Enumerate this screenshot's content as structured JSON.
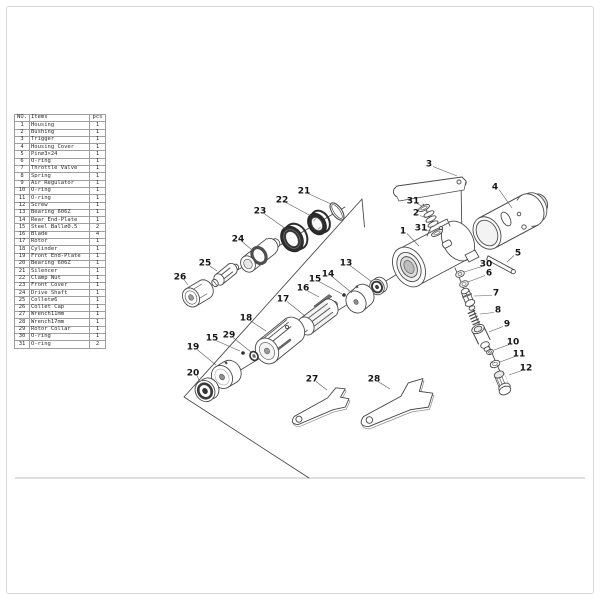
{
  "page": {
    "background": "#ffffff",
    "border_color": "#d8d8d8",
    "ink_color": "#4a4a4a",
    "sheet_line_color": "#bfbfbf"
  },
  "table": {
    "headers": [
      "NO.",
      "Items",
      "pcs"
    ],
    "rows": [
      [
        "1",
        "Housing",
        "1"
      ],
      [
        "2",
        "Bushing",
        "1"
      ],
      [
        "3",
        "Trigger",
        "1"
      ],
      [
        "4",
        "Housing Cover",
        "1"
      ],
      [
        "5",
        "Pin∅3×24",
        "1"
      ],
      [
        "6",
        "O-ring",
        "1"
      ],
      [
        "7",
        "Throttle Valve",
        "1"
      ],
      [
        "8",
        "Spring",
        "1"
      ],
      [
        "9",
        "Air Regulator",
        "1"
      ],
      [
        "10",
        "O-ring",
        "1"
      ],
      [
        "11",
        "O-ring",
        "1"
      ],
      [
        "12",
        "Screw",
        "1"
      ],
      [
        "13",
        "Bearing 606Z",
        "1"
      ],
      [
        "14",
        "Rear End-Plate",
        "1"
      ],
      [
        "15",
        "Steel Ball∅0.5",
        "2"
      ],
      [
        "16",
        "Blade",
        "4"
      ],
      [
        "17",
        "Rotor",
        "1"
      ],
      [
        "18",
        "Cylinder",
        "1"
      ],
      [
        "19",
        "Front End-Plate",
        "1"
      ],
      [
        "20",
        "Bearing 606Z",
        "1"
      ],
      [
        "21",
        "Silencer",
        "1"
      ],
      [
        "22",
        "Clamp Nut",
        "1"
      ],
      [
        "23",
        "Front Cover",
        "1"
      ],
      [
        "24",
        "Drive Shaft",
        "1"
      ],
      [
        "25",
        "Collet∅6",
        "1"
      ],
      [
        "26",
        "Collet Cap",
        "1"
      ],
      [
        "27",
        "Wrench11mm",
        "1"
      ],
      [
        "28",
        "Wrench17mm",
        "1"
      ],
      [
        "29",
        "Rotor Collar",
        "1"
      ],
      [
        "30",
        "O-ring",
        "1"
      ],
      [
        "31",
        "O-ring",
        "2"
      ]
    ]
  },
  "diagram": {
    "callouts": [
      {
        "n": "1",
        "part": "housing",
        "x": 403,
        "y": 231,
        "lx": 419,
        "ly": 246
      },
      {
        "n": "2",
        "part": "bushing",
        "x": 416,
        "y": 213,
        "lx": 426,
        "ly": 218
      },
      {
        "n": "3",
        "part": "trigger",
        "x": 429,
        "y": 164,
        "lx": 457,
        "ly": 176
      },
      {
        "n": "4",
        "part": "housing-cover",
        "x": 495,
        "y": 187,
        "lx": 512,
        "ly": 208
      },
      {
        "n": "5",
        "part": "pin",
        "x": 518,
        "y": 253,
        "lx": 507,
        "ly": 262
      },
      {
        "n": "31",
        "part": "o-ring",
        "x": 413,
        "y": 201,
        "lx": 422,
        "ly": 206
      },
      {
        "n": "31",
        "part": "o-ring",
        "x": 421,
        "y": 228,
        "lx": 431,
        "ly": 231
      },
      {
        "n": "30",
        "part": "o-ring",
        "x": 486,
        "y": 264,
        "lx": 464,
        "ly": 272
      },
      {
        "n": "6",
        "part": "o-ring",
        "x": 489,
        "y": 273,
        "lx": 468,
        "ly": 282
      },
      {
        "n": "7",
        "part": "throttle-valve",
        "x": 496,
        "y": 293,
        "lx": 474,
        "ly": 296
      },
      {
        "n": "8",
        "part": "spring",
        "x": 498,
        "y": 310,
        "lx": 480,
        "ly": 314
      },
      {
        "n": "9",
        "part": "air-regulator",
        "x": 507,
        "y": 324,
        "lx": 489,
        "ly": 332
      },
      {
        "n": "10",
        "part": "o-ring",
        "x": 513,
        "y": 342,
        "lx": 494,
        "ly": 350
      },
      {
        "n": "11",
        "part": "o-ring",
        "x": 519,
        "y": 354,
        "lx": 500,
        "ly": 362
      },
      {
        "n": "12",
        "part": "screw",
        "x": 526,
        "y": 368,
        "lx": 509,
        "ly": 375
      },
      {
        "n": "13",
        "part": "bearing",
        "x": 346,
        "y": 263,
        "lx": 372,
        "ly": 282
      },
      {
        "n": "14",
        "part": "rear-end-plate",
        "x": 328,
        "y": 274,
        "lx": 352,
        "ly": 293
      },
      {
        "n": "15",
        "part": "steel-ball",
        "x": 315,
        "y": 279,
        "lx": 342,
        "ly": 294
      },
      {
        "n": "16",
        "part": "blade",
        "x": 303,
        "y": 288,
        "lx": 319,
        "ly": 297
      },
      {
        "n": "17",
        "part": "rotor",
        "x": 283,
        "y": 299,
        "lx": 305,
        "ly": 316
      },
      {
        "n": "18",
        "part": "cylinder",
        "x": 246,
        "y": 318,
        "lx": 266,
        "ly": 331
      },
      {
        "n": "29",
        "part": "rotor-collar",
        "x": 229,
        "y": 335,
        "lx": 251,
        "ly": 352
      },
      {
        "n": "15",
        "part": "steel-ball",
        "x": 212,
        "y": 338,
        "lx": 240,
        "ly": 351
      },
      {
        "n": "19",
        "part": "front-end-plate",
        "x": 193,
        "y": 347,
        "lx": 216,
        "ly": 365
      },
      {
        "n": "20",
        "part": "bearing",
        "x": 193,
        "y": 373,
        "lx": 200,
        "ly": 382
      },
      {
        "n": "21",
        "part": "silencer",
        "x": 304,
        "y": 191,
        "lx": 331,
        "ly": 204
      },
      {
        "n": "22",
        "part": "clamp-nut",
        "x": 282,
        "y": 200,
        "lx": 311,
        "ly": 216
      },
      {
        "n": "23",
        "part": "front-cover",
        "x": 260,
        "y": 211,
        "lx": 286,
        "ly": 229
      },
      {
        "n": "24",
        "part": "drive-shaft",
        "x": 238,
        "y": 239,
        "lx": 252,
        "ly": 250
      },
      {
        "n": "25",
        "part": "collet",
        "x": 205,
        "y": 263,
        "lx": 217,
        "ly": 271
      },
      {
        "n": "26",
        "part": "collet-cap",
        "x": 180,
        "y": 277,
        "lx": 188,
        "ly": 285
      },
      {
        "n": "27",
        "part": "wrench-11mm",
        "x": 312,
        "y": 379,
        "lx": 327,
        "ly": 390
      },
      {
        "n": "28",
        "part": "wrench-17mm",
        "x": 374,
        "y": 379,
        "lx": 390,
        "ly": 389
      }
    ]
  }
}
